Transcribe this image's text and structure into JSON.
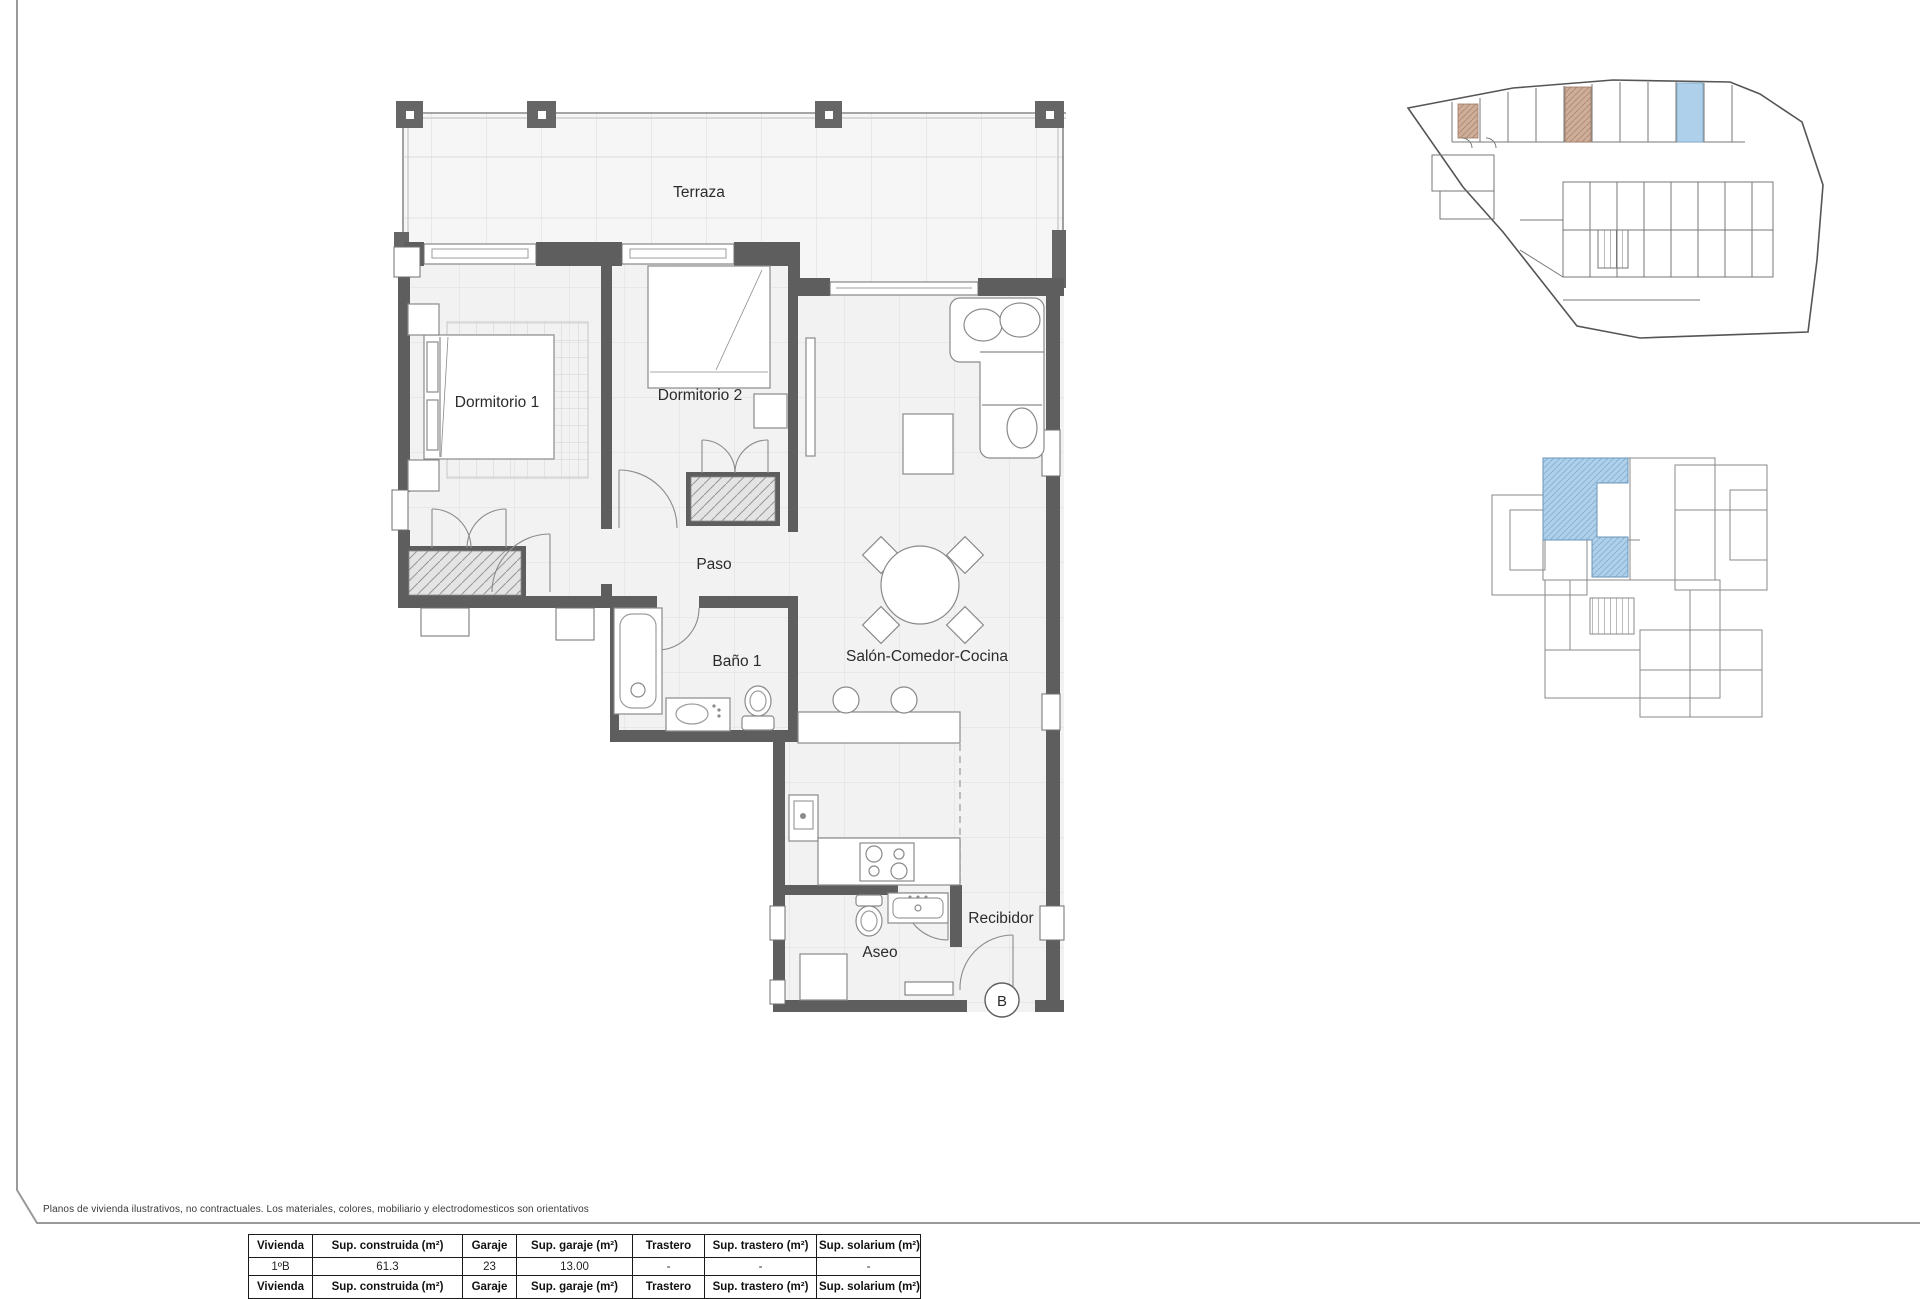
{
  "page": {
    "disclaimer": "Planos de vivienda ilustrativos, no contractuales. Los materiales, colores, mobiliario y electrodomesticos son orientativos"
  },
  "floorplan": {
    "rooms": {
      "terraza": "Terraza",
      "dormitorio1": "Dormitorio 1",
      "dormitorio2": "Dormitorio 2",
      "paso": "Paso",
      "bano1": "Baño 1",
      "salon": "Salón-Comedor-Cocina",
      "aseo": "Aseo",
      "recibidor": "Recibidor"
    },
    "unit_badge": "B"
  },
  "minimaps": {
    "garage_highlight": "garage space 23 highlighted",
    "keyplan_highlight": "unit 1ºB highlighted"
  },
  "table": {
    "headers": [
      "Vivienda",
      "Sup. construida (m²)",
      "Garaje",
      "Sup. garaje (m²)",
      "Trastero",
      "Sup. trastero (m²)",
      "Sup. solarium (m²)"
    ],
    "rows": [
      [
        "1ºB",
        "61.3",
        "23",
        "13.00",
        "-",
        "-",
        "-"
      ]
    ]
  },
  "colors": {
    "wall": "#5e5e5e",
    "floor": "#f2f2f2",
    "highlight_blue": "#aed0ea",
    "highlight_tan": "#cfae99"
  }
}
